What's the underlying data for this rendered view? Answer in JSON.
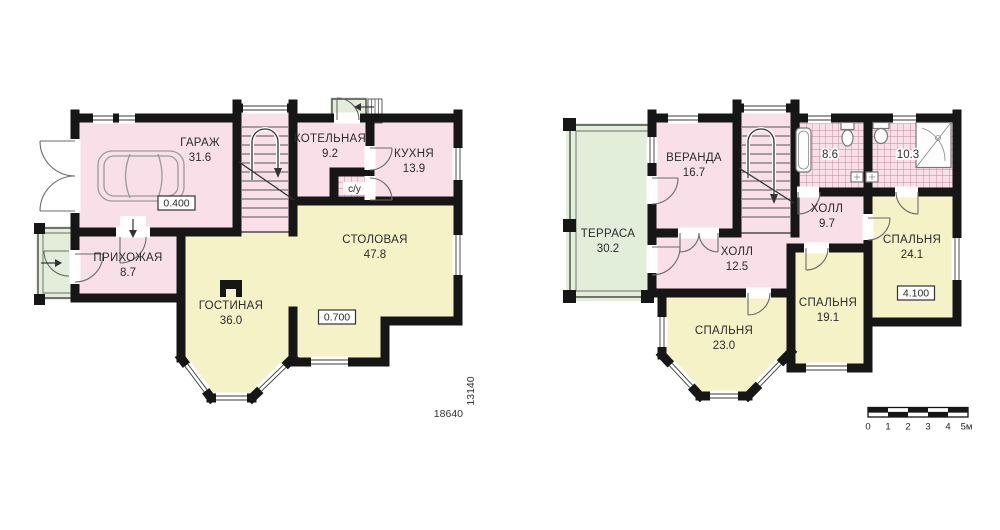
{
  "palette": {
    "bg": "#ffffff",
    "room_pink": "#f9e0e8",
    "room_yellow": "#f6f2c8",
    "porch_green": "#e2edda",
    "wall": "#161616",
    "text": "#2b2b2b"
  },
  "floor1": {
    "rooms": {
      "garage": {
        "name": "ГАРАЖ",
        "area": "31.6"
      },
      "boiler": {
        "name": "КОТЕЛЬНАЯ",
        "area": "9.2"
      },
      "kitchen": {
        "name": "КУХНЯ",
        "area": "13.9"
      },
      "wc": {
        "name": "с/у"
      },
      "hallway": {
        "name": "ПРИХОЖАЯ",
        "area": "8.7"
      },
      "living": {
        "name": "ГОСТИНАЯ",
        "area": "36.0"
      },
      "dining": {
        "name": "СТОЛОВАЯ",
        "area": "47.8"
      }
    },
    "level_marks": {
      "garage": "0.400",
      "dining": "0.700"
    },
    "dimensions": {
      "width_mm": "18640",
      "height_mm": "13140"
    }
  },
  "floor2": {
    "rooms": {
      "terrace": {
        "name": "ТЕРРАСА",
        "area": "30.2"
      },
      "veranda": {
        "name": "ВЕРАНДА",
        "area": "16.7"
      },
      "bath_small": {
        "area": "8.6"
      },
      "bath_big": {
        "area": "10.3"
      },
      "hall_upper": {
        "name": "ХОЛЛ",
        "area": "9.7"
      },
      "hall_lower": {
        "name": "ХОЛЛ",
        "area": "12.5"
      },
      "bedroom_right": {
        "name": "СПАЛЬНЯ",
        "area": "24.1"
      },
      "bedroom_mid": {
        "name": "СПАЛЬНЯ",
        "area": "19.1"
      },
      "bedroom_left": {
        "name": "СПАЛЬНЯ",
        "area": "23.0"
      }
    },
    "level_marks": {
      "bedroom_right": "4.100"
    }
  },
  "scale_bar": {
    "labels": [
      "0",
      "1",
      "2",
      "3",
      "4",
      "5м"
    ]
  }
}
